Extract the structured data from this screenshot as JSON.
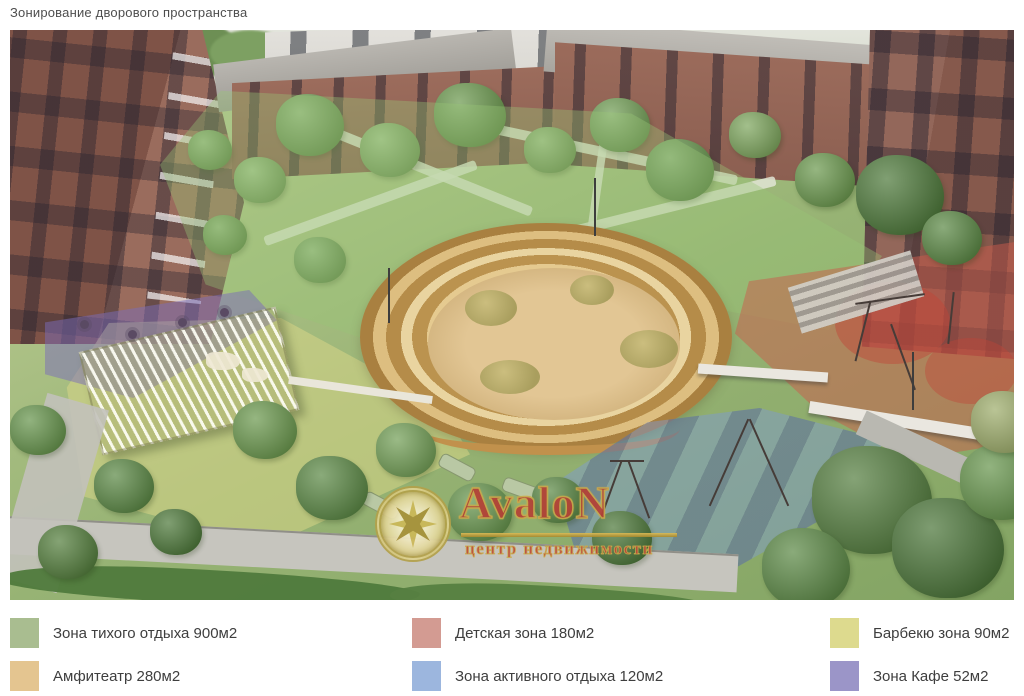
{
  "page": {
    "title": "Зонирование дворового пространства"
  },
  "watermark": {
    "brand": "AvaloN",
    "tagline": "центр недвижимости"
  },
  "legend": {
    "items": [
      {
        "label": "Зона тихого отдыха 900м2",
        "color": "#a9bd90"
      },
      {
        "label": "Детская зона 180м2",
        "color": "#d39b92"
      },
      {
        "label": "Барбекю зона 90м2",
        "color": "#ddda8e"
      },
      {
        "label": "Амфитеатр 280м2",
        "color": "#e4c590"
      },
      {
        "label": "Зона активного отдыха 120м2",
        "color": "#9cb6de"
      },
      {
        "label": "Зона Кафе 52м2",
        "color": "#9b95c8"
      }
    ]
  },
  "zones": {
    "quiet_overlay": "rgba(152,198,118,0.38)",
    "kids_overlay": "rgba(203,92,76,0.50)",
    "bbq_overlay": "rgba(219,214,136,0.52)",
    "active_overlay": "rgba(124,154,214,0.45)",
    "cafe_overlay": "rgba(122,108,185,0.50)",
    "amphitheater_primary": "#d9b26b"
  }
}
